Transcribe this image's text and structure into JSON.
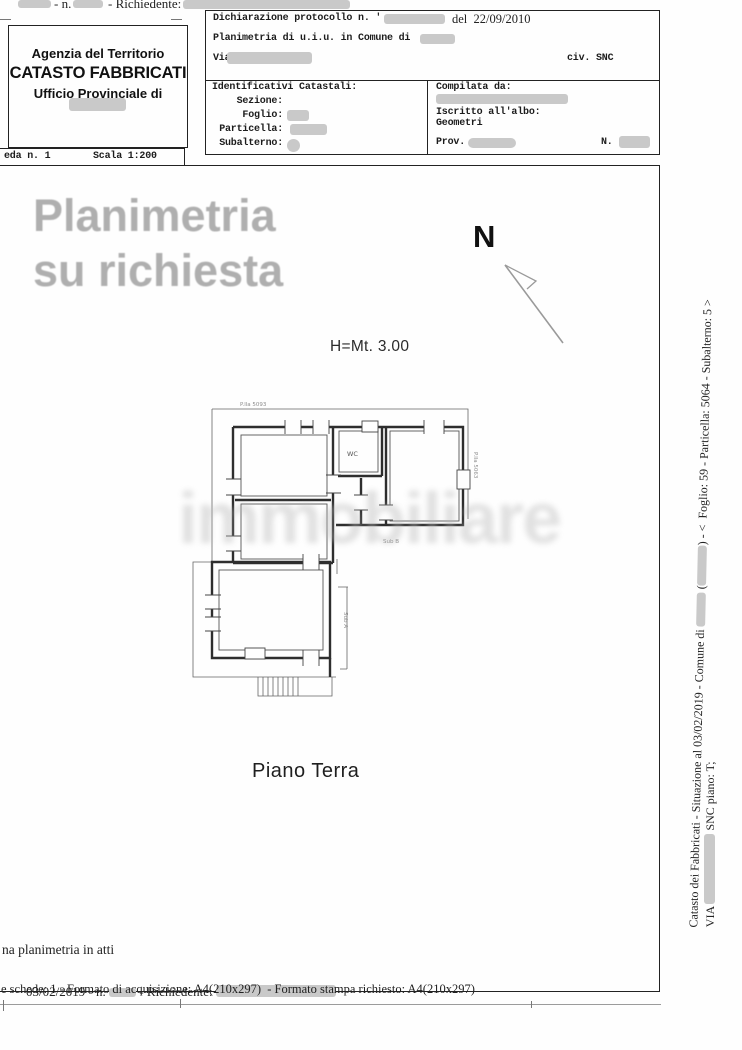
{
  "colors": {
    "redaction": "#c9c9c9",
    "watermark_gray": "#afafaf",
    "ghost_gray": "#b6b6b6",
    "ink": "#1c1c1c"
  },
  "top_strip": {
    "n_label": "- n.",
    "richiedente_label": "- Richiedente:"
  },
  "header_left": {
    "line1": "Agenzia del Territorio",
    "line2": "CATASTO FABBRICATI",
    "line3": "Ufficio Provinciale di"
  },
  "scheda_bar": {
    "scheda": "eda n. 1",
    "scala": "Scala 1:200"
  },
  "header_right": {
    "protocollo": "Dichiarazione protocollo n. '",
    "protocollo_date": "del  22/09/2010",
    "planimetria": "Planimetria di u.i.u. in Comune di",
    "via": "Via .",
    "civ": "civ. SNC",
    "identificativi_title": "Identificativi Catastali:",
    "sezione": "Sezione:",
    "foglio": "Foglio:",
    "particella": "Particella:",
    "subalterno": "Subalterno:",
    "compilata": "Compilata da:",
    "albo": "Iscritto all'albo:",
    "albo_cat": "Geometri",
    "prov": "Prov.",
    "n": "N."
  },
  "drawing": {
    "watermark_line1": "Planimetria",
    "watermark_line2": "su richiesta",
    "north_label": "N",
    "height_label": "H=Mt. 3.00",
    "floor_label": "Piano Terra",
    "ghost_watermark": "immobiliare",
    "plan_labels": {
      "parcel_top": "P.lla 5093",
      "parcel_right": "P.lla 5063",
      "wc": "WC",
      "sub_b": "Sub B",
      "sub_a": "Sub A"
    }
  },
  "right_margin": {
    "outer_a": "Catasto dei Fabbricati - Situazione al 03/02/2019 - Comune di ",
    "outer_b": " (",
    "outer_c": ") - <  Foglio: 59 - Particella: 5064 - Subalterno: 5 >",
    "inner_a": "VIA ",
    "inner_b": " SNC piano: T;"
  },
  "footer": {
    "atti": "na planimetria in atti",
    "date_n": "03/02/2019 - n.",
    "richiedente": "- Richiedente:",
    "formato": "e schede: 1 - Formato di acquisizione: A4(210x297)  - Formato stampa richiesto: A4(210x297)"
  }
}
